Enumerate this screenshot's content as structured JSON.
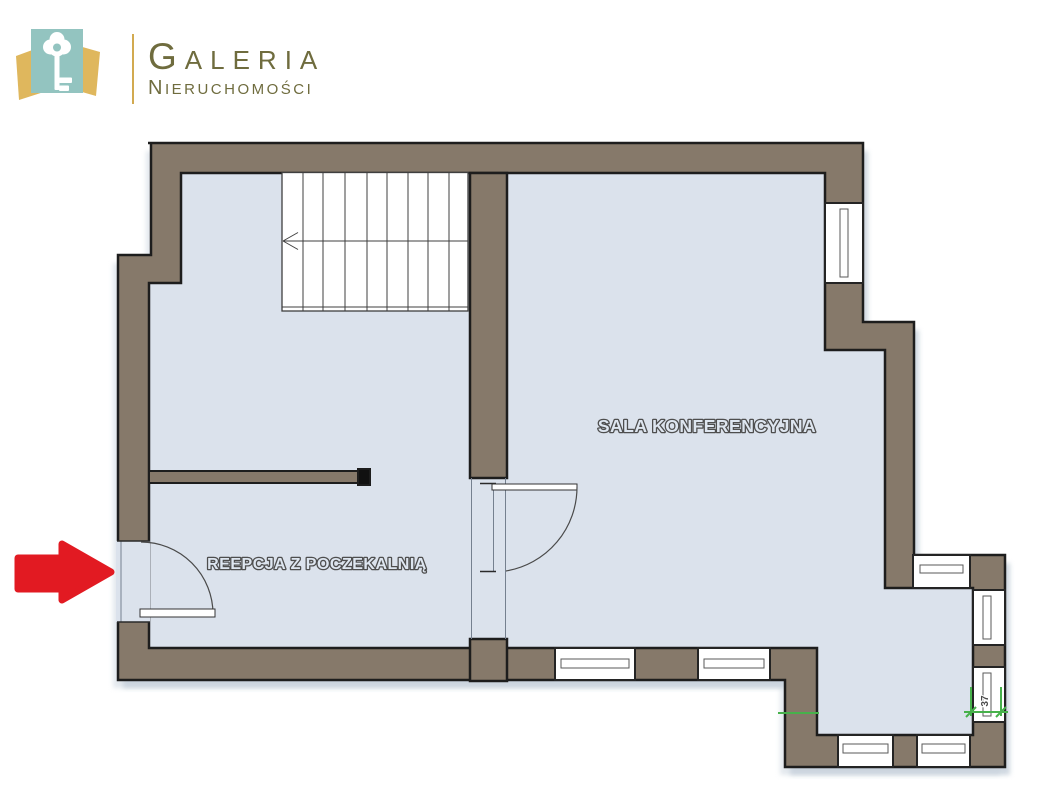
{
  "brand": {
    "title_initial": "G",
    "title_rest": "ALERIA",
    "subtitle_initial": "N",
    "subtitle_rest": "IERUCHOMOŚCI",
    "colors": {
      "teal": "#93c4c0",
      "gold": "#dfb75d",
      "divider": "#d2aa50",
      "text": "#6f6c3e"
    }
  },
  "floor_plan": {
    "labels": {
      "conference": "SALA KONFERENCYJNA",
      "reception": "REEPCJA Z POCZEKALNIĄ"
    },
    "dimension": {
      "value": "37"
    },
    "colors": {
      "wall": "#86796a",
      "floor": "#dbe2ec",
      "outline": "#1d1d1d",
      "accent_green": "#47b14b",
      "arrow_red": "#e21a22"
    }
  }
}
